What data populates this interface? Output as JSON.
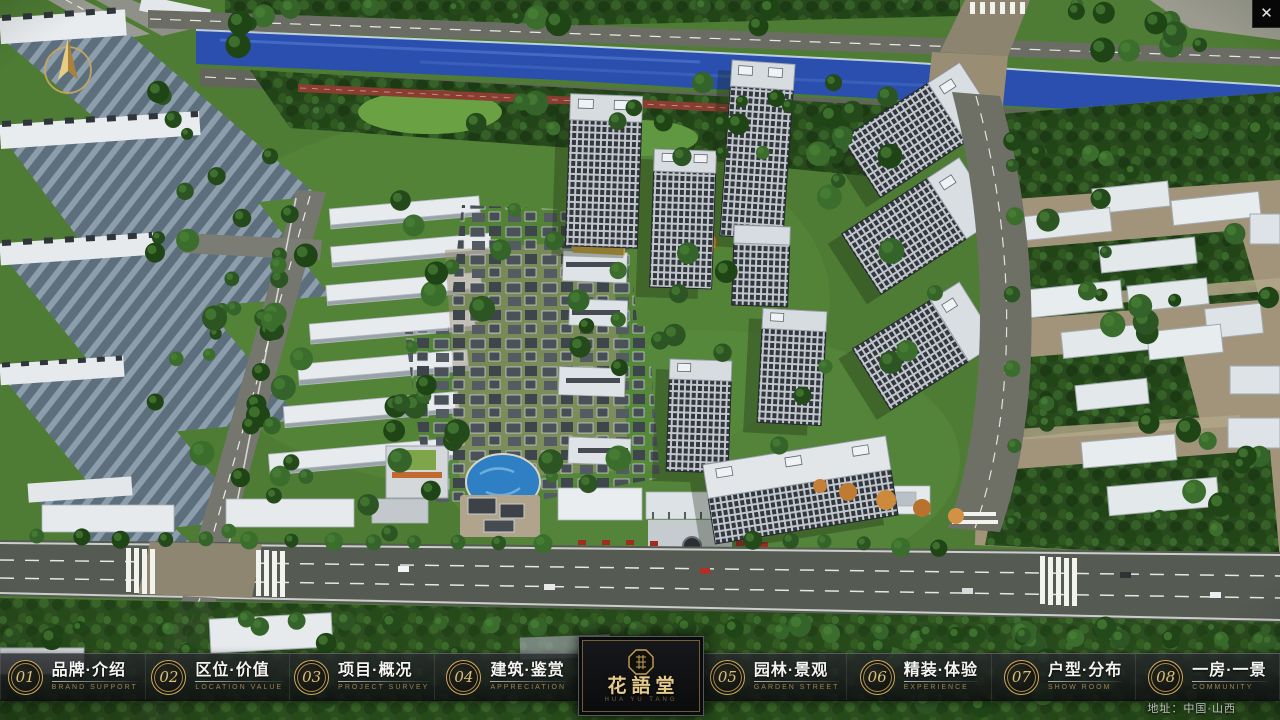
{
  "window": {
    "close_glyph": "✕"
  },
  "nav": {
    "items": [
      {
        "num": "01",
        "zh": "品牌·介绍",
        "en": "BRAND SUPPORT"
      },
      {
        "num": "02",
        "zh": "区位·价值",
        "en": "LOCATION VALUE"
      },
      {
        "num": "03",
        "zh": "项目·概况",
        "en": "PROJECT SURVEY"
      },
      {
        "num": "04",
        "zh": "建筑·鉴赏",
        "en": "APPRECIATION"
      },
      {
        "num": "05",
        "zh": "园林·景观",
        "en": "GARDEN STREET"
      },
      {
        "num": "06",
        "zh": "精装·体验",
        "en": "EXPERIENCE"
      },
      {
        "num": "07",
        "zh": "户型·分布",
        "en": "SHOW ROOM"
      },
      {
        "num": "08",
        "zh": "一房·一景",
        "en": "COMMUNITY"
      }
    ]
  },
  "logo": {
    "title": "花語堂",
    "subtitle": "HUA YU TANG"
  },
  "footer": {
    "address": "地址：中国·山西"
  },
  "colors": {
    "gold": "#c9a85f",
    "nav_bg": "rgba(16,18,21,0.8)",
    "river": "#2a4fae"
  }
}
